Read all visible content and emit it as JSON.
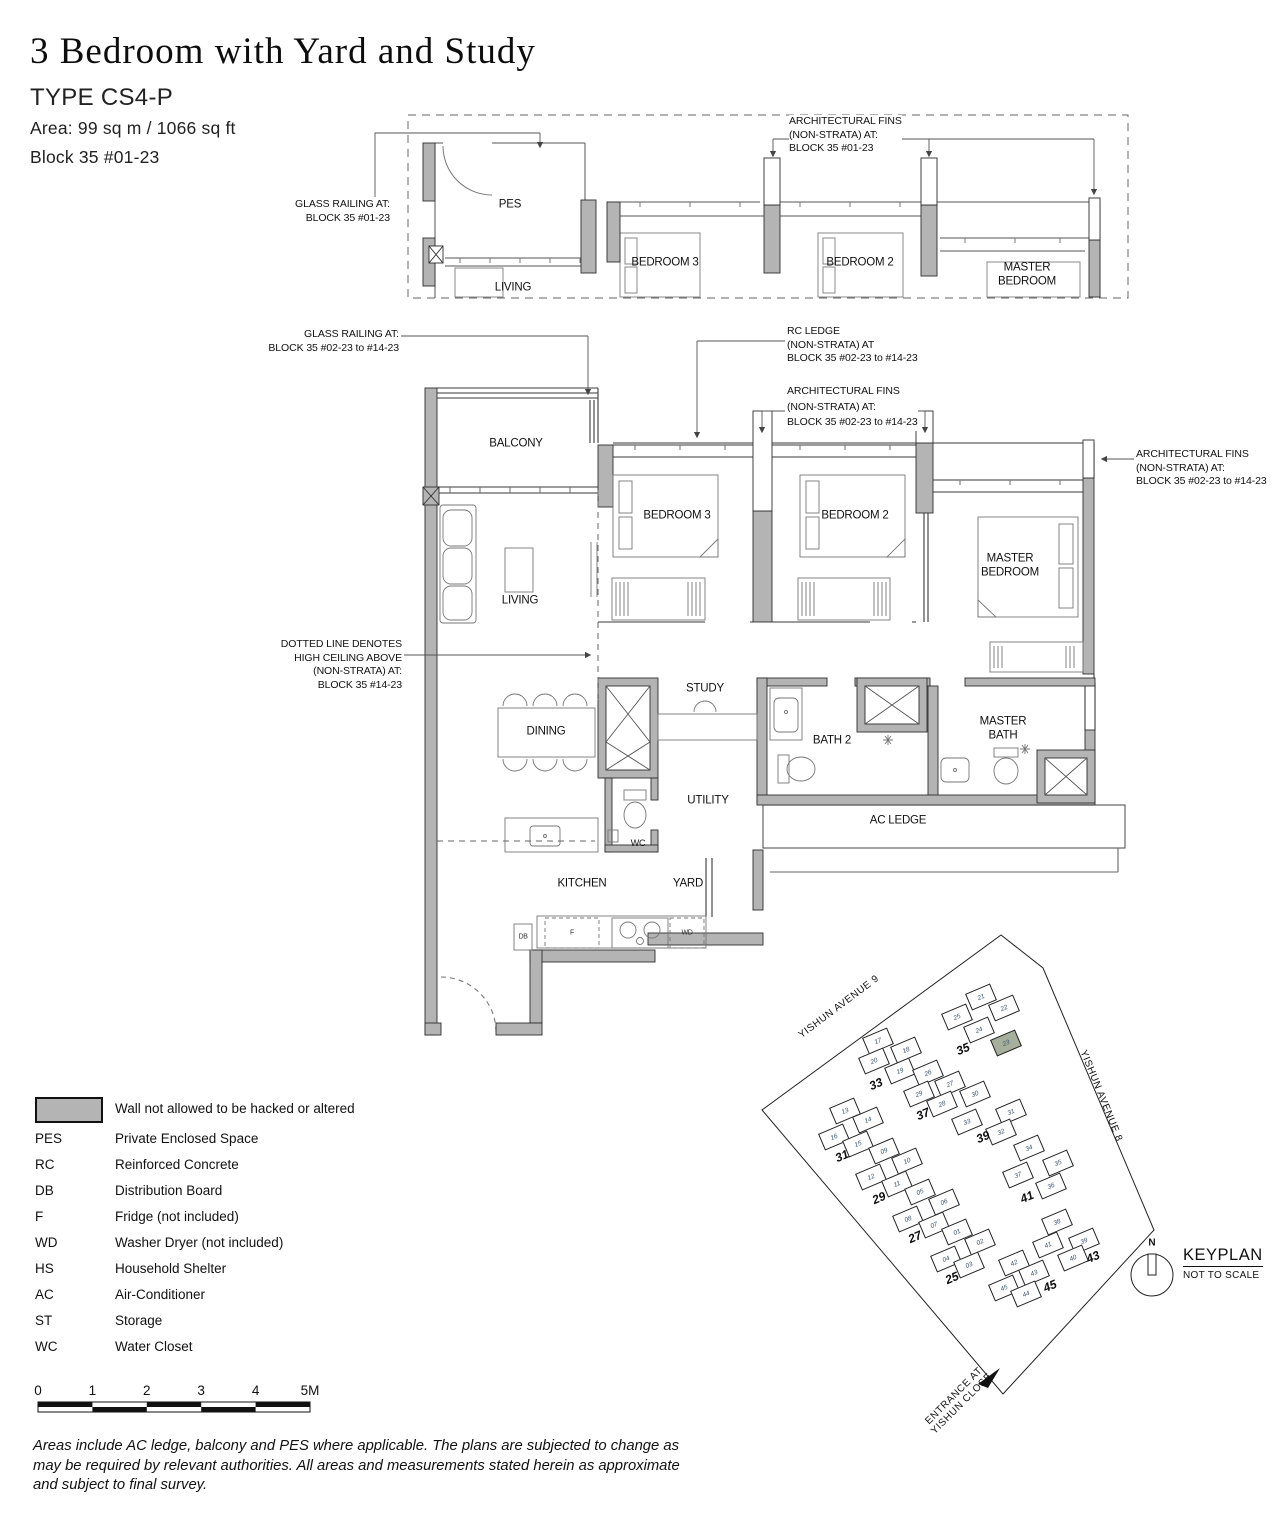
{
  "header": {
    "title": "3 Bedroom with Yard and Study",
    "type_label": "TYPE CS4-P",
    "area_label": "Area: 99 sq m / 1066 sq ft",
    "block_label": "Block 35 #01-23"
  },
  "upper_plan": {
    "rooms": {
      "pes": "PES",
      "living": "LIVING",
      "bedroom3": "BEDROOM 3",
      "bedroom2": "BEDROOM 2",
      "master_bedroom": "MASTER\nBEDROOM"
    },
    "annotations": {
      "glass_railing": "GLASS RAILING AT:\nBLOCK 35 #01-23",
      "arch_fins": "ARCHITECTURAL FINS\n(NON-STRATA) AT:\nBLOCK 35 #01-23"
    }
  },
  "main_plan": {
    "rooms": {
      "balcony": "BALCONY",
      "living": "LIVING",
      "bedroom3": "BEDROOM 3",
      "bedroom2": "BEDROOM 2",
      "master_bedroom": "MASTER\nBEDROOM",
      "dining": "DINING",
      "study": "STUDY",
      "bath2": "BATH 2",
      "master_bath": "MASTER\nBATH",
      "utility": "UTILITY",
      "wc": "WC",
      "ac_ledge": "AC LEDGE",
      "kitchen": "KITCHEN",
      "yard": "YARD",
      "db": "DB",
      "fridge": "F",
      "wd": "WD"
    },
    "annotations": {
      "glass_railing": "GLASS RAILING AT:\nBLOCK 35 #02-23 to #14-23",
      "rc_ledge": "RC LEDGE\n(NON-STRATA) AT\nBLOCK 35 #02-23 to #14-23",
      "arch_fins_top": "ARCHITECTURAL FINS\n(NON-STRATA) AT:\nBLOCK 35 #02-23 to #14-23",
      "arch_fins_right": "ARCHITECTURAL FINS\n(NON-STRATA) AT:\nBLOCK 35 #02-23 to #14-23",
      "high_ceiling": "DOTTED LINE DENOTES\nHIGH CEILING ABOVE\n(NON-STRATA) AT:\nBLOCK 35 #14-23"
    }
  },
  "legend": {
    "wall_note": "Wall not allowed to be hacked or altered",
    "entries": [
      {
        "key": "PES",
        "desc": "Private Enclosed Space"
      },
      {
        "key": "RC",
        "desc": "Reinforced Concrete"
      },
      {
        "key": "DB",
        "desc": "Distribution Board"
      },
      {
        "key": "F",
        "desc": "Fridge (not included)"
      },
      {
        "key": "WD",
        "desc": "Washer Dryer (not included)"
      },
      {
        "key": "HS",
        "desc": "Household Shelter"
      },
      {
        "key": "AC",
        "desc": "Air-Conditioner"
      },
      {
        "key": "ST",
        "desc": "Storage"
      },
      {
        "key": "WC",
        "desc": "Water Closet"
      }
    ]
  },
  "scale_bar": {
    "labels": [
      "0",
      "1",
      "2",
      "3",
      "4",
      "5M"
    ]
  },
  "disclaimer": "Areas include AC ledge, balcony and PES where applicable. The plans are subjected to change as\nmay be required by relevant authorities. All areas and measurements stated herein as approximate\nand subject to final survey.",
  "keyplan": {
    "title": "KEYPLAN",
    "subtitle": "NOT TO SCALE",
    "north_label": "N",
    "highlight_color": "#a6ae9c",
    "highlighted_unit": "23",
    "roads": {
      "avenue9": "YISHUN AVENUE 9",
      "avenue8": "YISHUN AVENUE 8",
      "entrance": "ENTRANCE AT\nYISHUN CLOSE"
    },
    "blocks": [
      {
        "number": "35",
        "lx": 963,
        "ly": 1049,
        "units": [
          {
            "n": "21",
            "x": 981,
            "y": 997
          },
          {
            "n": "22",
            "x": 1004,
            "y": 1008
          },
          {
            "n": "25",
            "x": 957,
            "y": 1017
          },
          {
            "n": "24",
            "x": 979,
            "y": 1030
          },
          {
            "n": "23",
            "x": 1006,
            "y": 1043,
            "hl": true
          }
        ]
      },
      {
        "number": "33",
        "lx": 876,
        "ly": 1084,
        "units": [
          {
            "n": "17",
            "x": 878,
            "y": 1041
          },
          {
            "n": "18",
            "x": 906,
            "y": 1050
          },
          {
            "n": "20",
            "x": 874,
            "y": 1061
          },
          {
            "n": "19",
            "x": 900,
            "y": 1071
          }
        ]
      },
      {
        "number": "37",
        "lx": 923,
        "ly": 1114,
        "units": [
          {
            "n": "26",
            "x": 928,
            "y": 1073
          },
          {
            "n": "27",
            "x": 950,
            "y": 1084
          },
          {
            "n": "29",
            "x": 919,
            "y": 1094
          },
          {
            "n": "28",
            "x": 942,
            "y": 1104
          }
        ]
      },
      {
        "number": "39",
        "lx": 983,
        "ly": 1137,
        "units": [
          {
            "n": "30",
            "x": 975,
            "y": 1094
          },
          {
            "n": "31",
            "x": 1011,
            "y": 1112
          },
          {
            "n": "33",
            "x": 967,
            "y": 1122
          },
          {
            "n": "32",
            "x": 1001,
            "y": 1132
          }
        ]
      },
      {
        "number": "31",
        "lx": 842,
        "ly": 1156,
        "units": [
          {
            "n": "13",
            "x": 845,
            "y": 1111
          },
          {
            "n": "14",
            "x": 868,
            "y": 1120
          },
          {
            "n": "16",
            "x": 834,
            "y": 1137
          },
          {
            "n": "15",
            "x": 858,
            "y": 1144
          }
        ]
      },
      {
        "number": "29",
        "lx": 879,
        "ly": 1198,
        "units": [
          {
            "n": "09",
            "x": 884,
            "y": 1151
          },
          {
            "n": "10",
            "x": 907,
            "y": 1161
          },
          {
            "n": "12",
            "x": 871,
            "y": 1177
          },
          {
            "n": "11",
            "x": 897,
            "y": 1184
          }
        ]
      },
      {
        "number": "27",
        "lx": 915,
        "ly": 1237,
        "units": [
          {
            "n": "05",
            "x": 920,
            "y": 1192
          },
          {
            "n": "06",
            "x": 944,
            "y": 1202
          },
          {
            "n": "08",
            "x": 908,
            "y": 1219
          },
          {
            "n": "07",
            "x": 934,
            "y": 1225
          }
        ]
      },
      {
        "number": "25",
        "lx": 952,
        "ly": 1278,
        "units": [
          {
            "n": "01",
            "x": 957,
            "y": 1232
          },
          {
            "n": "02",
            "x": 980,
            "y": 1242
          },
          {
            "n": "04",
            "x": 946,
            "y": 1259
          },
          {
            "n": "03",
            "x": 969,
            "y": 1265
          }
        ]
      },
      {
        "number": "41",
        "lx": 1027,
        "ly": 1197,
        "units": [
          {
            "n": "34",
            "x": 1029,
            "y": 1148
          },
          {
            "n": "35",
            "x": 1058,
            "y": 1163
          },
          {
            "n": "37",
            "x": 1018,
            "y": 1175
          },
          {
            "n": "36",
            "x": 1051,
            "y": 1186
          }
        ]
      },
      {
        "number": "43",
        "lx": 1093,
        "ly": 1257,
        "units": [
          {
            "n": "38",
            "x": 1057,
            "y": 1222
          },
          {
            "n": "39",
            "x": 1084,
            "y": 1241
          },
          {
            "n": "41",
            "x": 1048,
            "y": 1245
          },
          {
            "n": "40",
            "x": 1073,
            "y": 1258
          }
        ]
      },
      {
        "number": "45",
        "lx": 1050,
        "ly": 1286,
        "units": [
          {
            "n": "42",
            "x": 1014,
            "y": 1263
          },
          {
            "n": "43",
            "x": 1034,
            "y": 1273
          },
          {
            "n": "45",
            "x": 1004,
            "y": 1288
          },
          {
            "n": "44",
            "x": 1026,
            "y": 1294
          }
        ]
      }
    ]
  },
  "colors": {
    "wall_gray": "#b4b4b4",
    "line": "#3a3a3a",
    "accent_highlight": "#a6ae9c"
  }
}
